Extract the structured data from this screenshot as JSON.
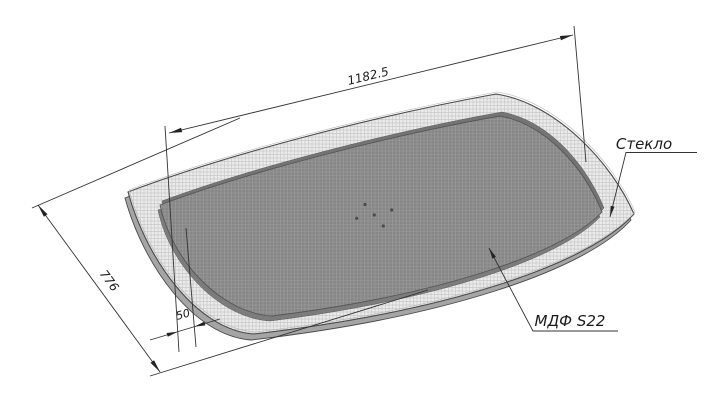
{
  "drawing": {
    "dimensions": {
      "length": "1182.5",
      "width": "776",
      "glass_border": "50"
    },
    "labels": {
      "glass": "Стекло",
      "mdf": "МДФ S22"
    },
    "colors": {
      "background": "#ffffff",
      "line": "#333333",
      "glass_fill": "#ebebeb",
      "glass_hatch": "#c9c9c9",
      "glass_side": "#a5a5a5",
      "mdf_fill": "#868686",
      "mdf_hatch": "#9d9d9d",
      "mdf_side": "#787878"
    }
  }
}
